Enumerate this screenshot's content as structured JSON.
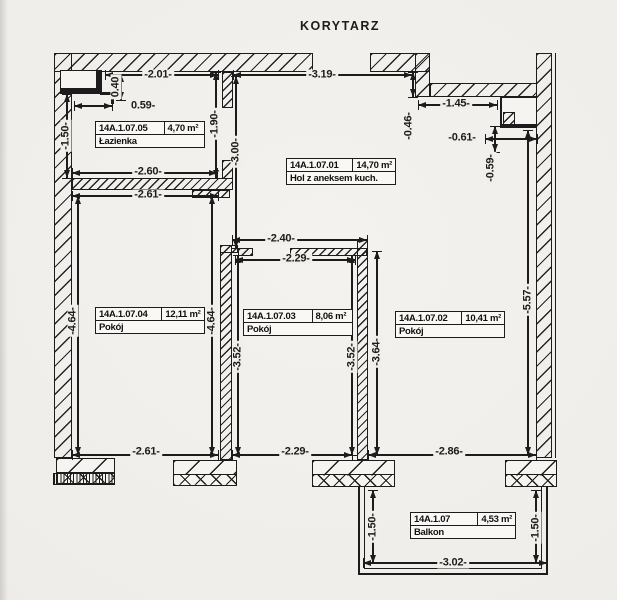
{
  "title": "KORYTARZ",
  "colors": {
    "paper": "#f1efeb",
    "ink": "#1c1c1c"
  },
  "rooms": [
    {
      "id": "14A.1.07.05",
      "area": "4,70 m²",
      "name": "Łazienka",
      "x": 95,
      "y": 121,
      "w": 108,
      "id_col": "57%"
    },
    {
      "id": "14A.1.07.01",
      "area": "14,70 m²",
      "name": "Hol z aneksem kuch.",
      "x": 286,
      "y": 158,
      "w": 108,
      "id_col": "55%"
    },
    {
      "id": "14A.1.07.04",
      "area": "12,11 m²",
      "name": "Pokój",
      "x": 95,
      "y": 307,
      "w": 108,
      "id_col": "55%"
    },
    {
      "id": "14A.1.07.03",
      "area": "8,06 m²",
      "name": "Pokój",
      "x": 243,
      "y": 309,
      "w": 108,
      "id_col": "57%"
    },
    {
      "id": "14A.1.07.02",
      "area": "10,41 m²",
      "name": "Pokój",
      "x": 395,
      "y": 311,
      "w": 108,
      "id_col": "55%"
    },
    {
      "id": "14A.1.07",
      "area": "4,53 m²",
      "name": "Balkon",
      "x": 410,
      "y": 512,
      "w": 104,
      "id_col": "63%"
    }
  ],
  "dimensions": [
    {
      "label": "-2.01-",
      "dir": "h",
      "x1": 105,
      "y1": 75,
      "x2": 218,
      "y2": 75,
      "tx": 158,
      "ty": 75
    },
    {
      "label": "-3.19-",
      "dir": "h",
      "x1": 233,
      "y1": 75,
      "x2": 412,
      "y2": 75,
      "tx": 322,
      "ty": 75
    },
    {
      "label": "0.40",
      "dir": "v",
      "x1": 121,
      "y1": 74,
      "x2": 121,
      "y2": 100,
      "tx": 116,
      "ty": 87
    },
    {
      "label": "0.59-",
      "dir": "h",
      "x1": 74,
      "y1": 106,
      "x2": 112,
      "y2": 106,
      "tx": 143,
      "ty": 106
    },
    {
      "label": "-1.50-",
      "dir": "v",
      "x1": 67,
      "y1": 94,
      "x2": 67,
      "y2": 178,
      "tx": 66,
      "ty": 136
    },
    {
      "label": "-1.90-",
      "dir": "v",
      "x1": 216,
      "y1": 72,
      "x2": 216,
      "y2": 178,
      "tx": 215,
      "ty": 124
    },
    {
      "label": "-3.00-",
      "dir": "v",
      "x1": 236,
      "y1": 76,
      "x2": 236,
      "y2": 248,
      "tx": 236,
      "ty": 152
    },
    {
      "label": "-2.60-",
      "dir": "h",
      "x1": 72,
      "y1": 173,
      "x2": 217,
      "y2": 173,
      "tx": 148,
      "ty": 172
    },
    {
      "label": "-2.61-",
      "dir": "h",
      "x1": 72,
      "y1": 196,
      "x2": 218,
      "y2": 196,
      "tx": 148,
      "ty": 195
    },
    {
      "label": "-1.45-",
      "dir": "h",
      "x1": 418,
      "y1": 105,
      "x2": 497,
      "y2": 105,
      "tx": 456,
      "ty": 104
    },
    {
      "label": "-0.46-",
      "dir": "v",
      "x1": 413,
      "y1": 72,
      "x2": 413,
      "y2": 97,
      "tx": 409,
      "ty": 126
    },
    {
      "label": "-0.61-",
      "dir": "h",
      "x1": 485,
      "y1": 139,
      "x2": 537,
      "y2": 139,
      "tx": 462,
      "ty": 138
    },
    {
      "label": "-0.59-",
      "dir": "v",
      "x1": 495,
      "y1": 126,
      "x2": 495,
      "y2": 152,
      "tx": 491,
      "ty": 168
    },
    {
      "label": "-5.57-",
      "dir": "v",
      "x1": 528,
      "y1": 130,
      "x2": 528,
      "y2": 455,
      "tx": 528,
      "ty": 300
    },
    {
      "label": "-2.40-",
      "dir": "h",
      "x1": 232,
      "y1": 240,
      "x2": 367,
      "y2": 240,
      "tx": 281,
      "ty": 239
    },
    {
      "label": "-2.29-",
      "dir": "h",
      "x1": 235,
      "y1": 260,
      "x2": 355,
      "y2": 260,
      "tx": 296,
      "ty": 259
    },
    {
      "label": "-4.64-",
      "dir": "v",
      "x1": 78,
      "y1": 196,
      "x2": 78,
      "y2": 455,
      "tx": 73,
      "ty": 321
    },
    {
      "label": "-4.64-",
      "dir": "v",
      "x1": 212,
      "y1": 196,
      "x2": 212,
      "y2": 455,
      "tx": 212,
      "ty": 321
    },
    {
      "label": "-3.52-",
      "dir": "v",
      "x1": 238,
      "y1": 255,
      "x2": 238,
      "y2": 455,
      "tx": 238,
      "ty": 357
    },
    {
      "label": "-3.52-",
      "dir": "v",
      "x1": 352,
      "y1": 255,
      "x2": 352,
      "y2": 455,
      "tx": 352,
      "ty": 357
    },
    {
      "label": "-3.64-",
      "dir": "v",
      "x1": 377,
      "y1": 251,
      "x2": 377,
      "y2": 455,
      "tx": 377,
      "ty": 352
    },
    {
      "label": "-2.61-",
      "dir": "h",
      "x1": 72,
      "y1": 455,
      "x2": 218,
      "y2": 455,
      "tx": 146,
      "ty": 452
    },
    {
      "label": "-2.29-",
      "dir": "h",
      "x1": 232,
      "y1": 455,
      "x2": 352,
      "y2": 455,
      "tx": 295,
      "ty": 452
    },
    {
      "label": "-2.86-",
      "dir": "h",
      "x1": 368,
      "y1": 455,
      "x2": 536,
      "y2": 455,
      "tx": 449,
      "ty": 452
    },
    {
      "label": "-1.50-",
      "dir": "v",
      "x1": 373,
      "y1": 490,
      "x2": 373,
      "y2": 563,
      "tx": 373,
      "ty": 527
    },
    {
      "label": "-1.50-",
      "dir": "v",
      "x1": 536,
      "y1": 490,
      "x2": 536,
      "y2": 563,
      "tx": 536,
      "ty": 528
    },
    {
      "label": "-3.02-",
      "dir": "h",
      "x1": 363,
      "y1": 563,
      "x2": 547,
      "y2": 563,
      "tx": 453,
      "ty": 563
    }
  ]
}
